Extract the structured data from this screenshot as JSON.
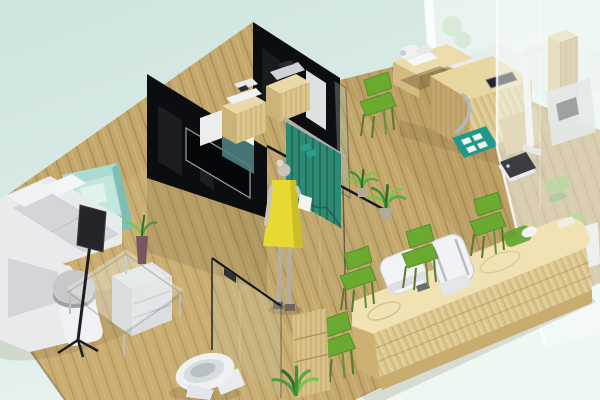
{
  "scene": {
    "title": "Isometric 3D rendering of a clinic interior with waiting lounge, curtained consultation rooms, examination area, reception counter and washroom",
    "style": "3d-isometric-architectural-render",
    "areas": {
      "waiting_lounge": {
        "items": [
          "white sectional sofa",
          "mint armchair with pillow",
          "gray dome cushion",
          "display on black tripod stand",
          "glass coffee table",
          "plant in purple vase",
          "light gray file cabinet"
        ]
      },
      "consultation_rooms": {
        "items": [
          "black glass partition with wall tv",
          "second black glass partition",
          "teal glass wall cabinet",
          "wooden cabinet with white printer",
          "wooden cabinet with gray terminal",
          "teal privacy curtain on rail",
          "standing person in yellow dress holding paper"
        ]
      },
      "exam_area": {
        "items": [
          "curved wooden exam desk",
          "white camera device",
          "embedded dark tablet",
          "chrome tube",
          "green side chair",
          "teal floor mat with white pads",
          "white height measuring stand",
          "dark weighing scale",
          "wooden slat column",
          "potted spider plants"
        ]
      },
      "reception": {
        "items": [
          "long rounded wooden counter",
          "white rounded terminal",
          "white high-back office chair",
          "four green visitor chairs",
          "green tray with white mouse",
          "dark desk item"
        ]
      },
      "washroom": {
        "items": [
          "glass partition with dark handle",
          "white toilet",
          "wooden shelf unit",
          "green floor plant"
        ]
      },
      "behind_glass": {
        "items": [
          "frosted glass wall with sink counter",
          "frosted right pane",
          "gray medical equipment silhouettes",
          "green seat pads"
        ]
      }
    }
  },
  "palette": {
    "bg_top": "#cfe4df",
    "bg_mid": "#d9ebe6",
    "bg_bottom": "#eef7f2",
    "floor": "#c4a76a",
    "floor_light": "#d8bd82",
    "floor_dark": "#8a7040",
    "wall_black": "#0c0d10",
    "tv": "#060709",
    "screen": "#23252b",
    "glass_edge": "#17181a",
    "sofa": "#e9eaec",
    "sofa_cushion": "#d4d5d9",
    "mint_chair": "#a9dcd2",
    "mint_chair_dark": "#7fbfb2",
    "curtain": "#2e8a74",
    "curtain_dark": "#1f6a58",
    "green_chair": "#6aaa30",
    "green_chair_dark": "#4f8a24",
    "plant": "#3f9138",
    "plant_light": "#7cc24f",
    "person_dress": "#e8d832",
    "person_skin": "#c9c4bb",
    "wood_light": "#f0e2b2",
    "wood_mid": "#dcc78e",
    "wood_dark": "#c9ad70",
    "device_white": "#f2f3f5",
    "device_gray": "#cfd2d4",
    "mat": "#21998a",
    "scale": "#3b3d43",
    "toilet": "#eef0f1",
    "frosted": "#eff5f2",
    "chrome": "#b3b9bd"
  }
}
